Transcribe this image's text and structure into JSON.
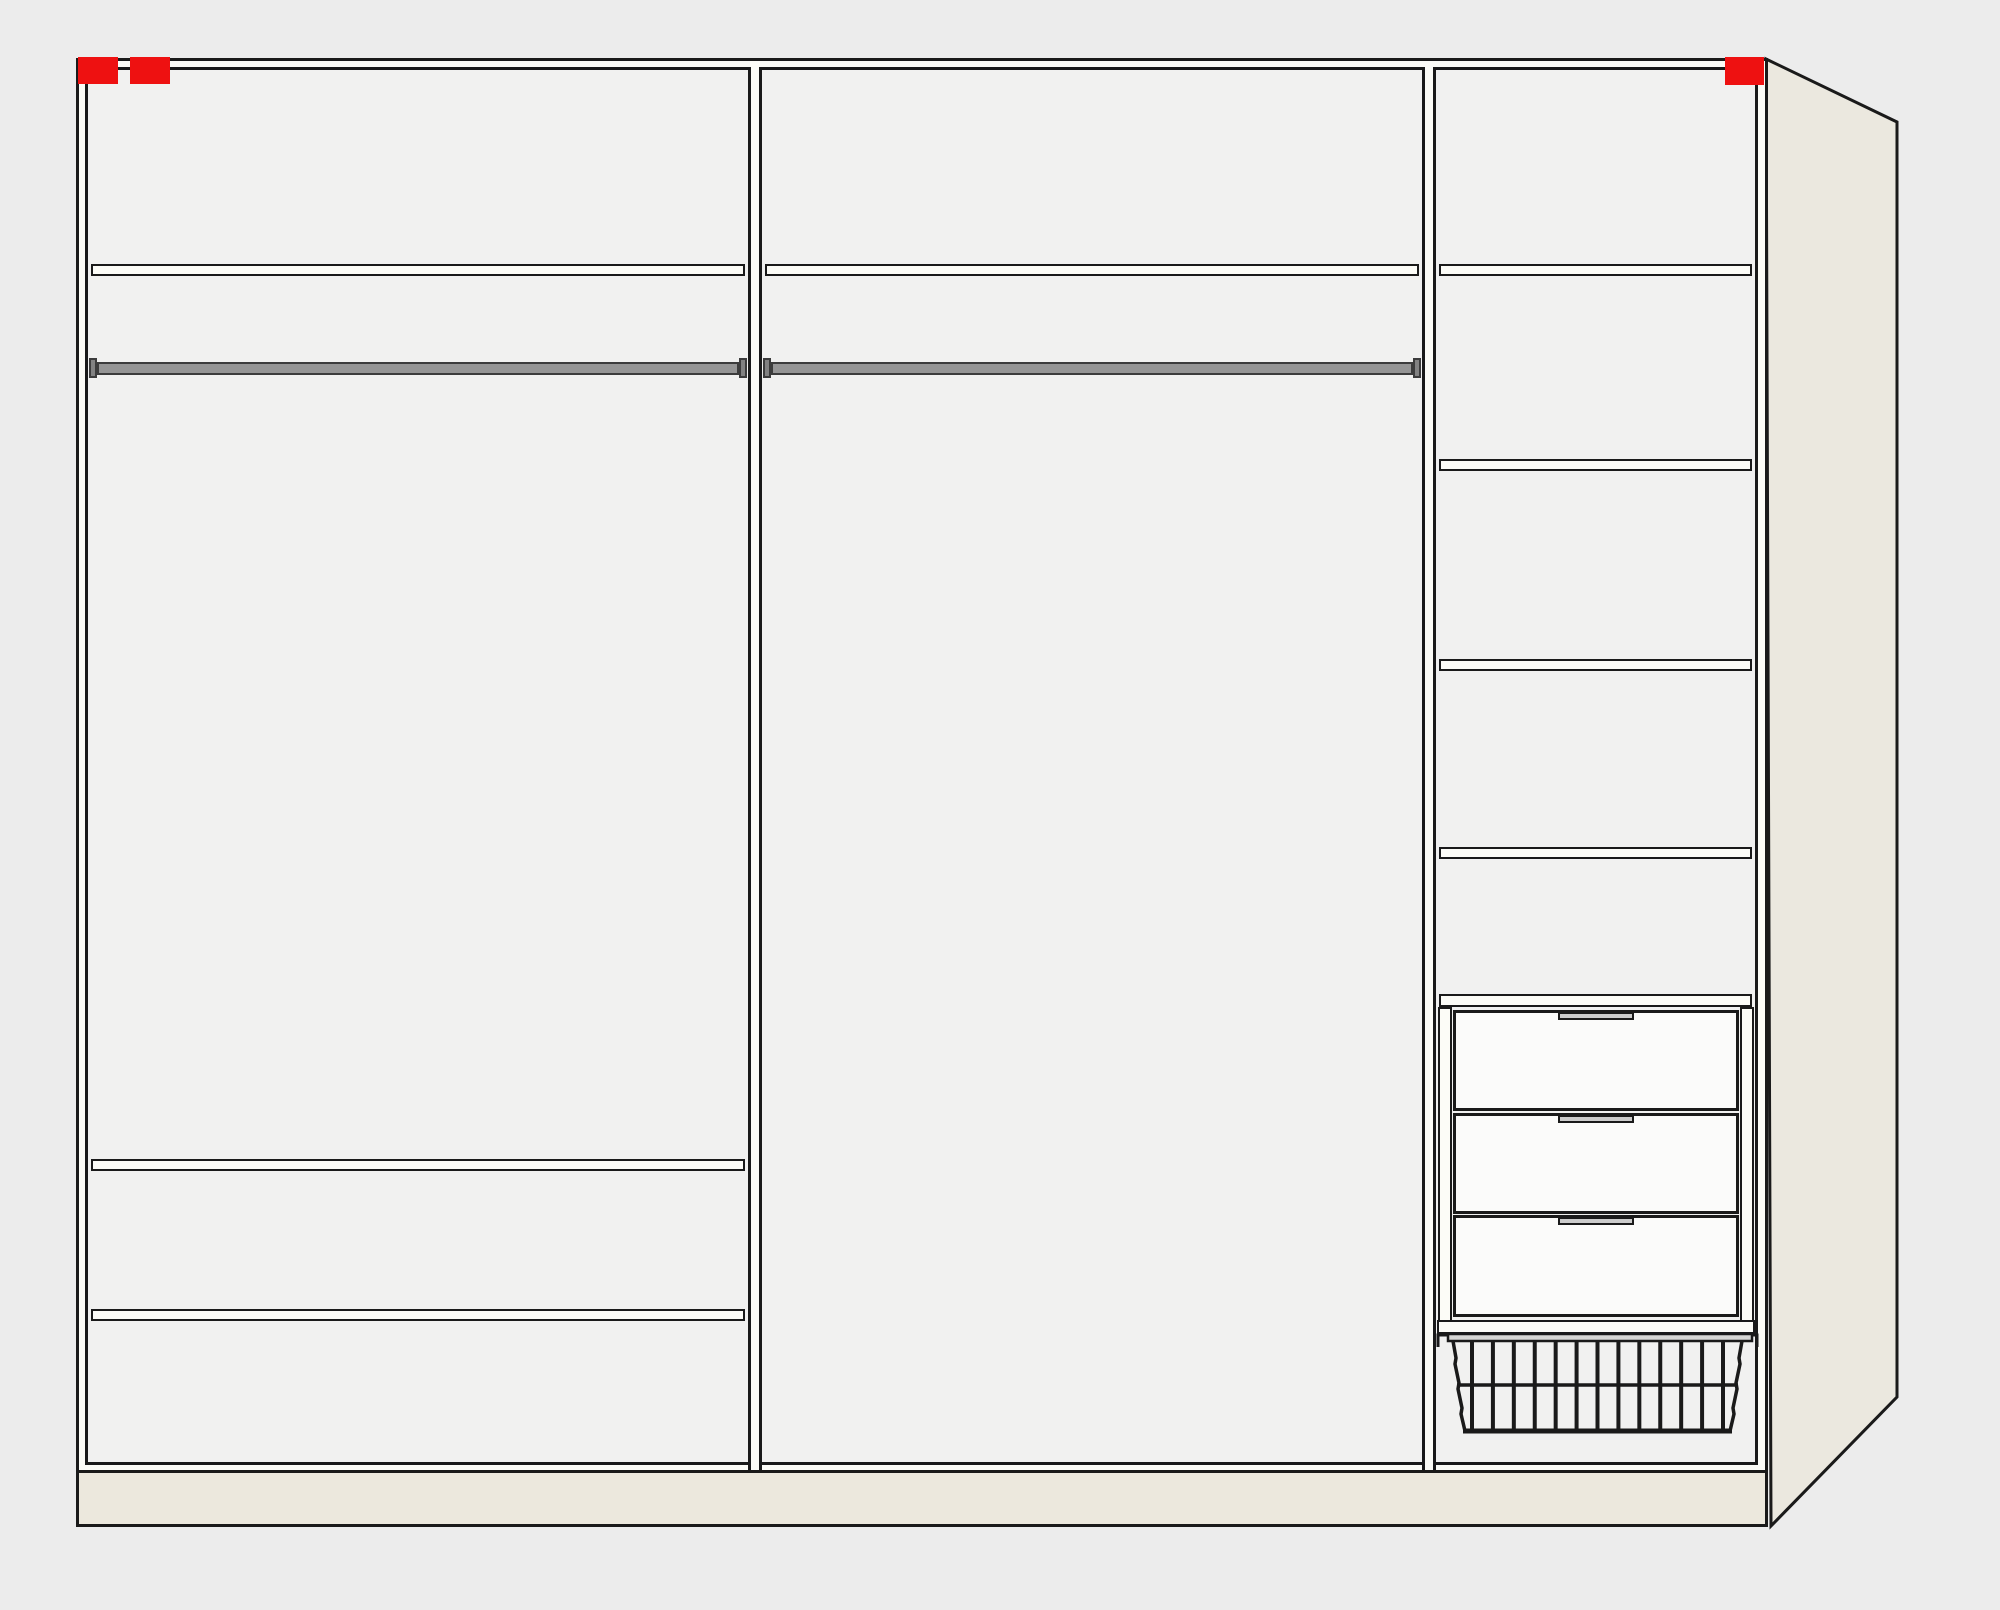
{
  "colors": {
    "bg": "#ececec",
    "interior": "#f1f1f0",
    "frame_core": "#fcfcf7",
    "outline": "#1a1a1a",
    "side_panel": "#ebe8df",
    "plinth": "#ece8dd",
    "rail": "#959595",
    "rail_edge": "#3c3c3c",
    "rail_bracket": "#828282",
    "drawer_front": "#fbfbfa",
    "drawer_handle": "#cccccc",
    "marker_red": "#ee1111",
    "basket_wire": "#1a1a1a",
    "basket_bar": "#d7d7d4"
  },
  "labels": {
    "wardrobe": "wardrobe carcass front view",
    "side_panel": "side panel perspective",
    "plinth": "plinth base",
    "left_section": "left section",
    "middle_section": "middle section",
    "right_section": "right section",
    "shelf": "shelf",
    "clothes_rail": "clothes rail",
    "drawer": "drawer",
    "wire_basket": "wire basket",
    "warning_marker": "red warning marker"
  },
  "markers": {
    "count": 3,
    "color_name": "red",
    "positions": [
      "top-left-a",
      "top-left-b",
      "top-right"
    ]
  },
  "sections": {
    "left": {
      "shelves": 3,
      "clothes_rails": 1
    },
    "middle": {
      "shelves": 1,
      "clothes_rails": 1
    },
    "right": {
      "shelves": 5,
      "drawers": 3,
      "wire_baskets": 1,
      "wire_basket_bars": 13
    }
  }
}
